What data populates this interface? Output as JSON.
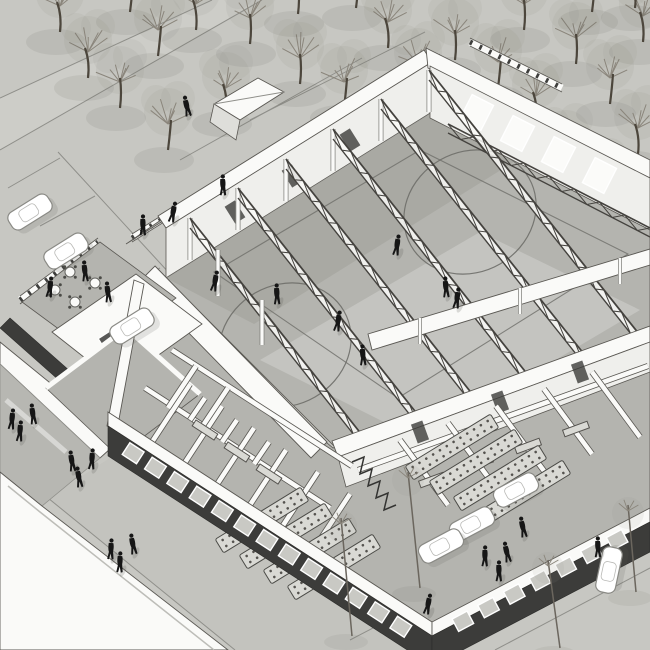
{
  "meta": {
    "type": "architectural-axonometric-rendering",
    "subject": "sports-hall-building-cutaway-aerial-view",
    "style": "monochrome-sketch"
  },
  "palette": {
    "ground": "#c7c7c2",
    "road": "#cdcdc8",
    "walkway": "#c3c3be",
    "line": "#8f8f8a",
    "white": "#fafaf8",
    "wall_edge": "#5a5853",
    "wall_face": "#efefec",
    "floor": "#b4b4af",
    "floor_dark": "#9d9d98",
    "court_line": "#6e6e69",
    "facade_dark": "#3c3c3a",
    "window_glass": "#c9c9c4",
    "window_frame": "#ffffff",
    "truss": "#44423e",
    "mullion": "#3e3e3c",
    "tree_trunk": "#4c463c",
    "tree_branch": "#8a857b",
    "tree_canopy": "#8f8f88",
    "person": "#161616",
    "shadow": "#55554f",
    "car_body": "#ffffff",
    "car_edge": "#8a8a85",
    "furniture": "#d9d9d4"
  },
  "scene": {
    "trees": {
      "top_left": [
        [
          88,
          78
        ],
        [
          120,
          108
        ],
        [
          158,
          56
        ],
        [
          196,
          30
        ],
        [
          250,
          44
        ],
        [
          168,
          150
        ],
        [
          226,
          114
        ],
        [
          300,
          84
        ],
        [
          344,
          108
        ],
        [
          388,
          48
        ],
        [
          298,
          14
        ],
        [
          356,
          8
        ],
        [
          418,
          90
        ],
        [
          455,
          60
        ],
        [
          130,
          12
        ],
        [
          60,
          32
        ]
      ],
      "top_right": [
        [
          498,
          88
        ],
        [
          536,
          122
        ],
        [
          576,
          64
        ],
        [
          610,
          104
        ],
        [
          643,
          42
        ],
        [
          566,
          172
        ],
        [
          600,
          207
        ],
        [
          638,
          154
        ],
        [
          524,
          30
        ],
        [
          592,
          12
        ],
        [
          635,
          8
        ],
        [
          487,
          152
        ]
      ],
      "saplings": [
        [
          352,
          636,
          341,
          518
        ],
        [
          420,
          588,
          408,
          472
        ],
        [
          560,
          648,
          548,
          560
        ],
        [
          636,
          592,
          628,
          505
        ]
      ]
    },
    "cars": [
      {
        "x": 30,
        "y": 212,
        "angle": -32
      },
      {
        "x": 66,
        "y": 251,
        "angle": -32
      },
      {
        "x": 132,
        "y": 326,
        "angle": -32
      },
      {
        "x": 516,
        "y": 490,
        "angle": -28
      },
      {
        "x": 472,
        "y": 524,
        "angle": -28
      },
      {
        "x": 441,
        "y": 546,
        "angle": -28
      },
      {
        "x": 609,
        "y": 570,
        "angle": -78
      }
    ],
    "people": {
      "plaza": [
        [
          187,
          107
        ]
      ],
      "corridor": [
        [
          143,
          226
        ],
        [
          173,
          213
        ],
        [
          223,
          186
        ]
      ],
      "court": [
        [
          215,
          282
        ],
        [
          277,
          295
        ],
        [
          338,
          322
        ],
        [
          363,
          356
        ],
        [
          397,
          246
        ],
        [
          446,
          288
        ],
        [
          457,
          299
        ]
      ],
      "terrace": [
        [
          85,
          272
        ],
        [
          50,
          288
        ],
        [
          108,
          293
        ]
      ],
      "walkway": [
        [
          12,
          420
        ],
        [
          33,
          415
        ],
        [
          20,
          432
        ],
        [
          72,
          462
        ],
        [
          92,
          460
        ],
        [
          79,
          478
        ],
        [
          111,
          550
        ],
        [
          133,
          545
        ],
        [
          120,
          563
        ]
      ],
      "street": [
        [
          523,
          528
        ],
        [
          485,
          557
        ],
        [
          507,
          553
        ],
        [
          499,
          572
        ],
        [
          428,
          605
        ],
        [
          598,
          548
        ]
      ]
    },
    "trusses": {
      "spans": [
        [
          190,
          218,
          362,
          435
        ],
        [
          238,
          188,
          418,
          415
        ],
        [
          286,
          159,
          473,
          395
        ],
        [
          333,
          129,
          528,
          375
        ],
        [
          381,
          99,
          584,
          354
        ],
        [
          429,
          70,
          639,
          334
        ]
      ],
      "post_height": 42
    },
    "court": {
      "circles": [
        {
          "cx": 285,
          "cy": 345,
          "rx": 68,
          "ry": 60,
          "rot": -30
        },
        {
          "cx": 470,
          "cy": 212,
          "rx": 68,
          "ry": 60,
          "rot": -30
        }
      ],
      "center_dot": [
        293,
        350
      ],
      "boundary": [
        [
          214,
          272
        ],
        [
          420,
          150
        ],
        [
          628,
          254
        ],
        [
          398,
          398
        ]
      ]
    },
    "windows": {
      "front": {
        "count": 13,
        "from": [
          122,
          446
        ],
        "to": [
          412,
          634
        ],
        "w": 17,
        "h": 14,
        "angle": 33
      },
      "right": {
        "count": 7,
        "from": [
          450,
          628
        ],
        "to": [
          630,
          533
        ],
        "w": 17,
        "h": 14,
        "angle": -28
      },
      "hall_back": {
        "count": 4,
        "from": [
          456,
          102
        ],
        "to": [
          620,
          186
        ],
        "w": 24,
        "h": 28,
        "angle": 27
      }
    },
    "doors": {
      "hall_back_wall": [
        [
          235,
          212
        ],
        [
          292,
          176
        ],
        [
          350,
          140
        ]
      ],
      "hall_front_wall": [
        [
          420,
          432
        ],
        [
          500,
          402
        ],
        [
          580,
          372
        ]
      ]
    },
    "partitions": {
      "front_wing": [
        [
          145,
          388,
          330,
          508
        ],
        [
          172,
          350,
          352,
          466
        ],
        [
          152,
          442,
          190,
          384
        ],
        [
          184,
          464,
          222,
          406
        ],
        [
          216,
          486,
          254,
          428
        ],
        [
          248,
          508,
          286,
          450
        ],
        [
          280,
          530,
          318,
          472
        ],
        [
          312,
          552,
          350,
          494
        ],
        [
          168,
          408,
          196,
          366
        ],
        [
          200,
          430,
          228,
          388
        ],
        [
          190,
          420,
          205,
          398
        ],
        [
          222,
          442,
          237,
          420
        ],
        [
          254,
          464,
          269,
          442
        ]
      ],
      "right_wing": [
        [
          358,
          470,
          648,
          366
        ],
        [
          400,
          440,
          448,
          505
        ],
        [
          448,
          423,
          496,
          488
        ],
        [
          496,
          406,
          544,
          471
        ],
        [
          544,
          389,
          592,
          454
        ],
        [
          592,
          372,
          640,
          437
        ]
      ]
    },
    "benches": {
      "front_wing": [
        [
          205,
          430,
          33
        ],
        [
          237,
          452,
          33
        ],
        [
          269,
          474,
          33
        ]
      ],
      "right_wing": [
        [
          432,
          480,
          -20
        ],
        [
          480,
          463,
          -20
        ],
        [
          528,
          446,
          -20
        ],
        [
          576,
          429,
          -20
        ]
      ]
    },
    "table_rows": {
      "dir": [
        0.85,
        -0.52
      ],
      "half_len": 50,
      "angle": -31.5,
      "groups": [
        {
          "rows": [
            [
              262,
              520
            ],
            [
              286,
              536
            ],
            [
              310,
              551
            ],
            [
              334,
              567
            ]
          ]
        },
        {
          "rows": [
            [
              452,
              447
            ],
            [
              476,
              462
            ],
            [
              500,
              478
            ],
            [
              524,
              493
            ]
          ]
        }
      ]
    },
    "terrace_tables": [
      [
        55,
        290
      ],
      [
        75,
        302
      ],
      [
        95,
        283
      ],
      [
        70,
        272
      ],
      [
        115,
        300
      ],
      [
        135,
        315
      ]
    ],
    "stairs_zigzag": [
      [
        352,
        462
      ],
      [
        364,
        457
      ],
      [
        360,
        474
      ],
      [
        372,
        469
      ],
      [
        368,
        486
      ],
      [
        380,
        481
      ],
      [
        376,
        498
      ],
      [
        388,
        493
      ],
      [
        384,
        510
      ],
      [
        396,
        505
      ]
    ],
    "glazing_lines": [
      [
        132,
        238,
        398,
        72
      ],
      [
        20,
        300,
        98,
        242
      ],
      [
        142,
        310,
        210,
        262
      ],
      [
        470,
        42,
        562,
        88
      ]
    ],
    "parking_lines_tl": [
      [
        8,
        188,
        60,
        158
      ],
      [
        40,
        226,
        95,
        196
      ],
      [
        105,
        298,
        160,
        268
      ],
      [
        138,
        338,
        192,
        308
      ],
      [
        58,
        152,
        205,
        312
      ]
    ],
    "street_lines_br": [
      [
        350,
        640,
        650,
        483
      ],
      [
        430,
        650,
        650,
        535
      ],
      [
        533,
        578,
        650,
        522
      ],
      [
        495,
        650,
        650,
        568
      ]
    ],
    "plaza_lines": [
      [
        180,
        160,
        362,
        58
      ],
      [
        250,
        120,
        425,
        32
      ]
    ],
    "overhead_beam_posts": [
      [
        420,
        318,
        420,
        344
      ],
      [
        520,
        288,
        520,
        314
      ],
      [
        620,
        258,
        620,
        284
      ]
    ],
    "band_a_posts": [
      [
        218,
        296,
        218,
        250
      ],
      [
        262,
        345,
        262,
        300
      ]
    ],
    "lattice_strips": [
      [
        448,
        124,
        650,
        228
      ]
    ]
  }
}
